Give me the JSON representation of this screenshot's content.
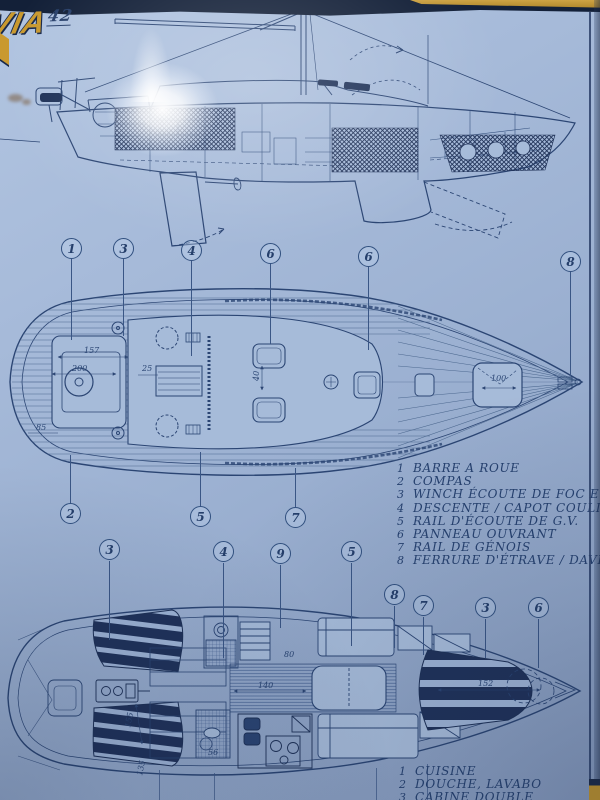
{
  "logo": {
    "brand": "VIA",
    "model": "42"
  },
  "deck_legend": {
    "items": [
      {
        "num": "1",
        "label": "BARRE A ROUE"
      },
      {
        "num": "2",
        "label": "COMPAS"
      },
      {
        "num": "3",
        "label": "WINCH ÉCOUTE DE FOC ET SPI"
      },
      {
        "num": "4",
        "label": "DESCENTE / CAPOT COULISSANT"
      },
      {
        "num": "5",
        "label": "RAIL D'ÉCOUTE DE G.V."
      },
      {
        "num": "6",
        "label": "PANNEAU OUVRANT"
      },
      {
        "num": "7",
        "label": "RAIL DE GÉNOIS"
      },
      {
        "num": "8",
        "label": "FERRURE D'ÉTRAVE / DAVIER"
      }
    ]
  },
  "interior_legend": {
    "items": [
      {
        "num": "1",
        "label": "CUISINE"
      },
      {
        "num": "2",
        "label": "DOUCHE, LAVABO"
      },
      {
        "num": "3",
        "label": "CABINE DOUBLE"
      }
    ]
  },
  "callouts": {
    "deck_top": [
      "1",
      "3",
      "4",
      "6",
      "6",
      "8"
    ],
    "deck_bottom": [
      "2",
      "5",
      "7"
    ],
    "interior_top": [
      "3",
      "4",
      "9",
      "5"
    ],
    "interior_right": [
      "8",
      "7",
      "3",
      "6"
    ]
  },
  "dims": {
    "deck": [
      "157",
      "200",
      "85",
      "25",
      "40",
      "100"
    ],
    "interior": [
      "140",
      "152",
      "155",
      "135",
      "80",
      "56"
    ]
  },
  "colors": {
    "page_blue": "#9fb4d4",
    "ink_navy": "#2b4573",
    "dark_fill": "#1e3157",
    "gold": "#c9992f"
  }
}
